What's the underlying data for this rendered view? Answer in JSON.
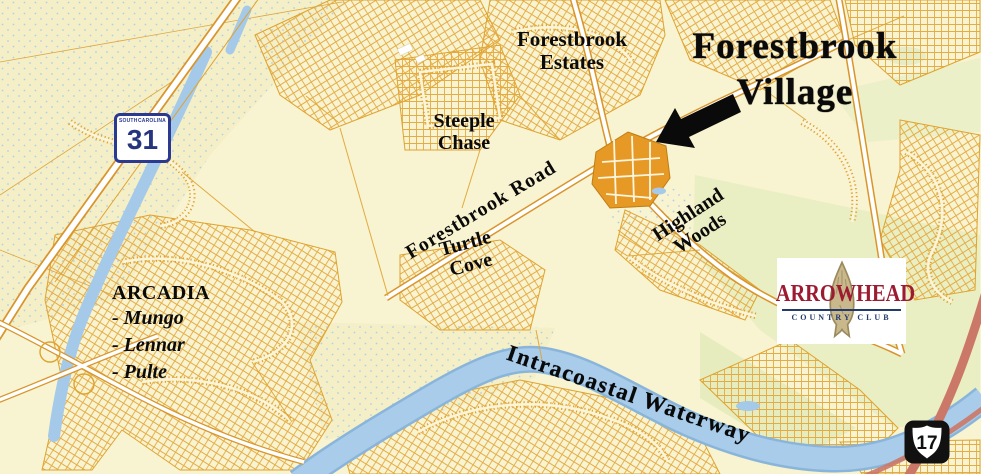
{
  "map": {
    "title": {
      "line1": "Forestbrook",
      "line2": "Village"
    },
    "labels": {
      "forestbrook_estates": {
        "line1": "Forestbrook",
        "line2": "Estates"
      },
      "steeple_chase": {
        "line1": "Steeple",
        "line2": "Chase"
      },
      "forestbrook_road": "Forestbrook Road",
      "turtle_cove": {
        "line1": "Turtle",
        "line2": "Cove"
      },
      "highland_woods": {
        "line1": "Highland",
        "line2": "Woods"
      },
      "intracoastal_waterway": "Intracoastal Waterway",
      "arcadia": {
        "title": "ARCADIA",
        "builders": [
          "- Mungo",
          "- Lennar",
          "- Pulte"
        ]
      }
    },
    "shields": {
      "sc31": {
        "state_left": "SOUTH",
        "state_right": "CAROLINA",
        "number": "31"
      },
      "us17": {
        "number": "17"
      }
    },
    "logo": {
      "name": "ARROWHEAD",
      "subtitle": "COUNTRY CLUB"
    },
    "colors": {
      "background": "#F8F3D0",
      "streets": "#E2A235",
      "water": "#A8CCEA",
      "village_highlight": "#E79925",
      "red_road": "#CB7868",
      "logo_red": "#9C1B31",
      "logo_navy": "#233B6C",
      "shield_blue": "#2B3990",
      "us17_black": "#111111"
    }
  }
}
